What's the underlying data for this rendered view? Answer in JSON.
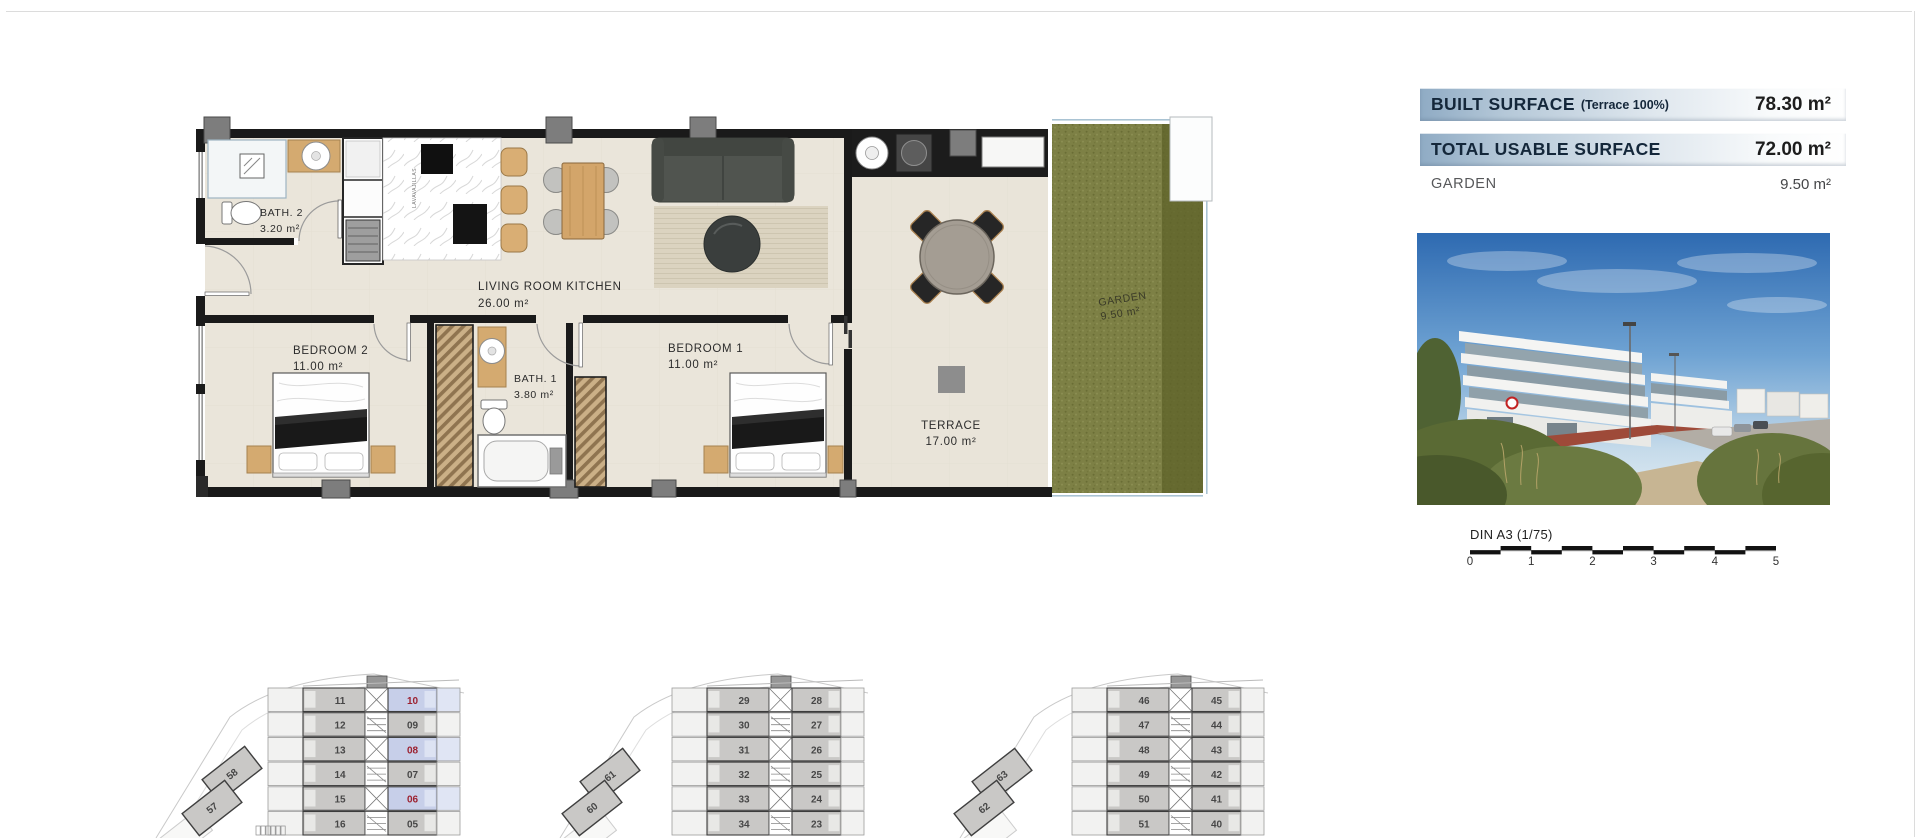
{
  "surface_table": {
    "rows": [
      {
        "label": "BUILT SURFACE",
        "sublabel": "(Terrace 100%)",
        "value": "78.30 m²"
      },
      {
        "label": "TOTAL USABLE SURFACE",
        "sublabel": "",
        "value": "72.00 m²"
      },
      {
        "label": "GARDEN",
        "sublabel": "",
        "value": "9.50 m²"
      }
    ]
  },
  "floorplan": {
    "rooms": {
      "bath2": {
        "name": "BATH. 2",
        "area": "3.20 m²"
      },
      "living": {
        "name": "LIVING ROOM KITCHEN",
        "area": "26.00 m²"
      },
      "bedroom2": {
        "name": "BEDROOM 2",
        "area": "11.00 m²"
      },
      "bath1": {
        "name": "BATH. 1",
        "area": "3.80 m²"
      },
      "bedroom1": {
        "name": "BEDROOM 1",
        "area": "11.00 m²"
      },
      "terrace": {
        "name": "TERRACE",
        "area": "17.00 m²"
      },
      "garden": {
        "name": "GARDEN",
        "area": "9.50 m²"
      }
    },
    "appliance_label": "LAVAVAJILLAS"
  },
  "scale_bar": {
    "label": "DIN A3 (1/75)",
    "ticks": [
      "0",
      "1",
      "2",
      "3",
      "4",
      "5"
    ]
  },
  "keyplans": [
    {
      "left": [
        "11",
        "12",
        "13",
        "14",
        "15",
        "16"
      ],
      "right": [
        "10",
        "09",
        "08",
        "07",
        "06",
        "05"
      ],
      "highlighted_right": [
        0,
        2,
        4
      ],
      "angled": [
        "58",
        "57"
      ]
    },
    {
      "left": [
        "29",
        "30",
        "31",
        "32",
        "33",
        "34"
      ],
      "right": [
        "28",
        "27",
        "26",
        "25",
        "24",
        "23"
      ],
      "highlighted_right": [],
      "angled": [
        "61",
        "60"
      ]
    },
    {
      "left": [
        "46",
        "47",
        "48",
        "49",
        "50",
        "51"
      ],
      "right": [
        "45",
        "44",
        "43",
        "42",
        "41",
        "40"
      ],
      "highlighted_right": [],
      "angled": [
        "63",
        "62"
      ]
    }
  ],
  "colors": {
    "table_band_blue": "#9db7cd",
    "highlight_cell_blue": "#c7cfe9",
    "highlight_number_red": "#9c2130",
    "wall_black": "#1a1a1a",
    "grass_green": "#7d8045",
    "floor_beige": "#eae5da"
  }
}
